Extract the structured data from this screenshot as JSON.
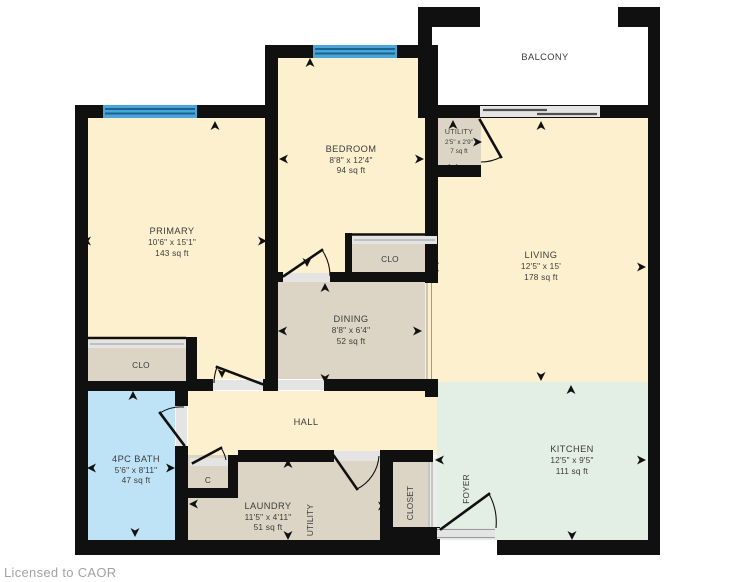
{
  "rooms": {
    "balcony": {
      "name": "BALCONY"
    },
    "primary": {
      "name": "PRIMARY",
      "dims": "10'6\" x 15'1\"",
      "area": "143 sq ft"
    },
    "bedroom": {
      "name": "BEDROOM",
      "dims": "8'8\" x 12'4\"",
      "area": "94 sq ft"
    },
    "utility_small": {
      "name": "UTILITY",
      "dims": "2'5\" x 2'9\"",
      "area": "7 sq ft"
    },
    "living": {
      "name": "LIVING",
      "dims": "12'5\" x 15'",
      "area": "178 sq ft"
    },
    "clo_bedroom": {
      "name": "CLO"
    },
    "dining": {
      "name": "DINING",
      "dims": "8'8\" x 6'4\"",
      "area": "52 sq ft"
    },
    "clo_primary": {
      "name": "CLO"
    },
    "bath": {
      "name": "4PC BATH",
      "dims": "5'6\" x 8'11\"",
      "area": "47 sq ft"
    },
    "hall": {
      "name": "HALL"
    },
    "c_closet": {
      "name": "C"
    },
    "laundry": {
      "name": "LAUNDRY",
      "dims": "11'5\" x 4'11\"",
      "area": "51 sq ft"
    },
    "utility_room": {
      "name": "UTILITY"
    },
    "closet": {
      "name": "CLOSET"
    },
    "foyer": {
      "name": "FOYER"
    },
    "kitchen": {
      "name": "KITCHEN",
      "dims": "12'5\" x 9'5\"",
      "area": "111 sq ft"
    }
  },
  "footer": {
    "license": "Licensed to CAOR"
  },
  "colors": {
    "wall": "#101010",
    "room_fill": "#fcf0cf",
    "closet_fill": "#dcd5c5",
    "bath_fill": "#bfe3f6",
    "kitchen_fill": "#e3eee4",
    "window": "#4ba5d8"
  }
}
